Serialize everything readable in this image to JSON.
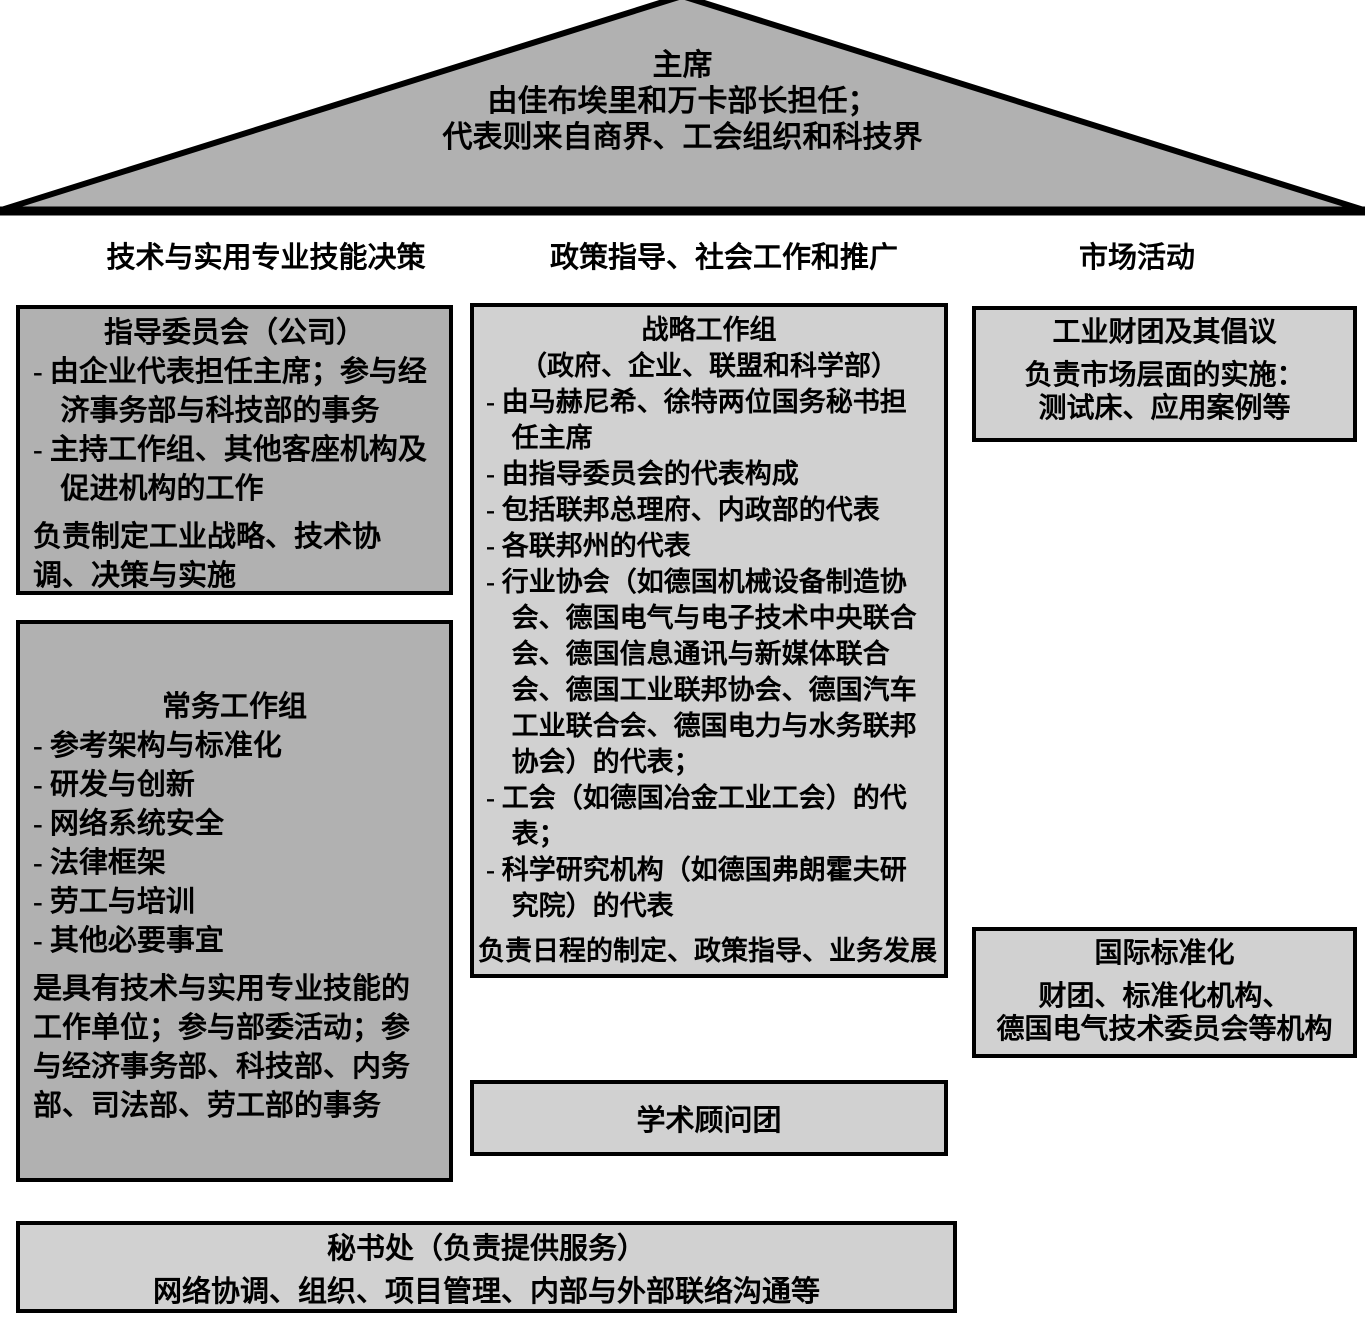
{
  "roof": {
    "title": "主席",
    "line2": "由佳布埃里和万卡部长担任；",
    "line3": "代表则来自商界、工会组织和科技界"
  },
  "headers": {
    "left": "技术与实用专业技能决策",
    "middle": "政策指导、社会工作和推广",
    "right": "市场活动"
  },
  "steering_committee": {
    "title": "指导委员会（公司）",
    "items": [
      "- 由企业代表担任主席；参与经济事务部与科技部的事务",
      "- 主持工作组、其他客座机构及促进机构的工作"
    ],
    "footer": "负责制定工业战略、技术协调、决策与实施"
  },
  "standing_group": {
    "title": "常务工作组",
    "items": [
      "- 参考架构与标准化",
      "- 研发与创新",
      "- 网络系统安全",
      "- 法律框架",
      "- 劳工与培训",
      "- 其他必要事宜"
    ],
    "footer": "是具有技术与实用专业技能的工作单位；参与部委活动；参与经济事务部、科技部、内务部、司法部、劳工部的事务"
  },
  "strategy_group": {
    "title": "战略工作组",
    "subtitle": "（政府、企业、联盟和科学部）",
    "items": [
      "- 由马赫尼希、徐特两位国务秘书担任主席",
      "- 由指导委员会的代表构成",
      "- 包括联邦总理府、内政部的代表",
      "- 各联邦州的代表",
      "- 行业协会（如德国机械设备制造协会、德国电气与电子技术中央联合会、德国信息通讯与新媒体联合会、德国工业联邦协会、德国汽车工业联合会、德国电力与水务联邦协会）的代表；",
      "- 工会（如德国冶金工业工会）的代表；",
      "- 科学研究机构（如德国弗朗霍夫研究院）的代表"
    ],
    "footer": "负责日程的制定、政策指导、业务发展"
  },
  "academic_board": {
    "title": "学术顾问团"
  },
  "industry_consortium": {
    "title": "工业财团及其倡议",
    "line1": "负责市场层面的实施：",
    "line2": "测试床、应用案例等"
  },
  "intl_standardization": {
    "title": "国际标准化",
    "line1": "财团、标准化机构、",
    "line2": "德国电气技术委员会等机构"
  },
  "secretariat": {
    "title": "秘书处（负责提供服务）",
    "body": "网络协调、组织、项目管理、内部与外部联络沟通等"
  },
  "colors": {
    "roof_fill": "#b1b1b1",
    "dark_box_fill": "#b1b1b1",
    "light_box_fill": "#d1d1d1",
    "border": "#000000",
    "text": "#000000",
    "background": "#ffffff"
  }
}
